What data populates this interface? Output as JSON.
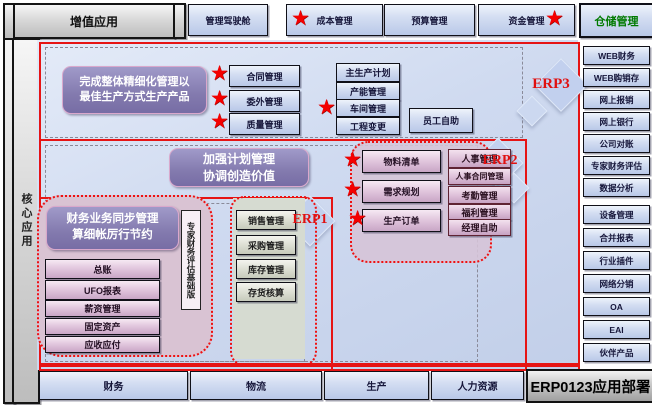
{
  "title_bars": {
    "value_added": "增值应用",
    "core_apps": "核心应用",
    "deploy": "ERP0123应用部署"
  },
  "top_buttons": [
    "管理驾驶舱",
    "成本管理",
    "预算管理",
    "资金管理",
    "仓储管理"
  ],
  "right_sidebar": [
    "WEB财务",
    "WEB购销存",
    "网上报销",
    "网上银行",
    "公司对账",
    "专家财务评估",
    "数据分析",
    "设备管理",
    "合并报表",
    "行业插件",
    "网络分销",
    "OA",
    "EAI",
    "伙伴产品"
  ],
  "bottom_buttons": [
    "财务",
    "物流",
    "生产",
    "人力资源"
  ],
  "zone_labels": {
    "erp1": "ERP1",
    "erp2": "ERP2",
    "erp3": "ERP3"
  },
  "callouts": {
    "production_goal": {
      "line1": "完成整体精细化管理以",
      "line2": "最佳生产方式生产产品"
    },
    "planning": {
      "line1": "加强计划管理",
      "line2": "协调创造价值"
    },
    "finance": {
      "line1": "财务业务同步管理",
      "line2": "算细帐厉行节约"
    },
    "expert_edition": "专家财务评估基础版"
  },
  "modules": {
    "quality_contract": [
      "合同管理",
      "委外管理",
      "质量管理"
    ],
    "production": [
      "主生产计划",
      "产能管理",
      "车间管理",
      "工程变更"
    ],
    "employee_self_service": "员工自助",
    "material_planning": [
      "物料清单",
      "需求规划",
      "生产订单"
    ],
    "hr": [
      "人事管理",
      "人事合同管理",
      "考勤管理",
      "福利管理",
      "经理自助"
    ],
    "finance": [
      "总账",
      "UFO报表",
      "薪资管理",
      "固定资产",
      "应收应付"
    ],
    "logistics": [
      "销售管理",
      "采购管理",
      "库存管理",
      "存货核算"
    ]
  },
  "icons": {
    "star": "★"
  },
  "colors": {
    "accent_red": "#e61414",
    "star_red": "#f40000",
    "warehouse_green": "#007a00",
    "dashed_gray": "#8a8a99"
  }
}
